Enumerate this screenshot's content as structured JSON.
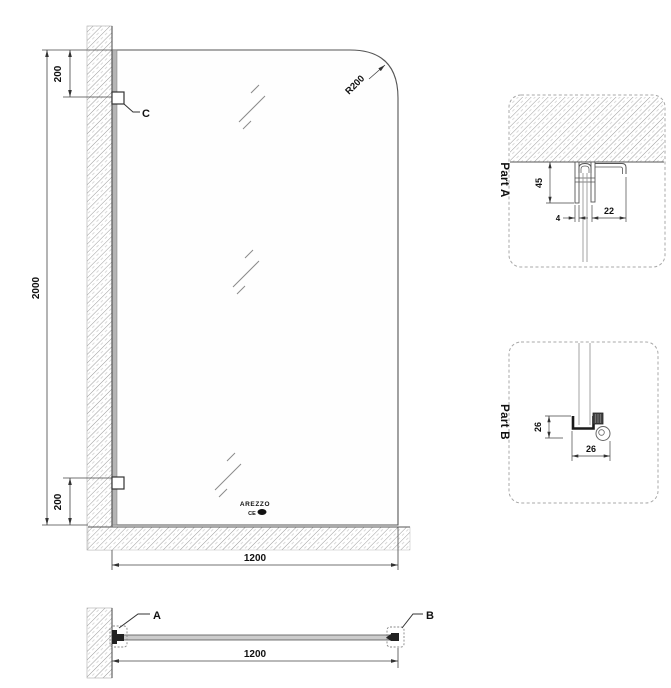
{
  "drawing": {
    "main_view": {
      "dim_total_height": "2000",
      "dim_top_offset": "200",
      "dim_bottom_offset": "200",
      "dim_width": "1200",
      "corner_radius_label": "R200",
      "bracket_label_c": "C",
      "logo_line1": "AREZZO",
      "logo_line2": "CE"
    },
    "plan_view": {
      "bracket_label_a": "A",
      "bracket_label_b": "B",
      "dim_width": "1200"
    },
    "part_a": {
      "title": "Part A",
      "dim_depth": "45",
      "dim_gap": "4",
      "dim_arm": "22"
    },
    "part_b": {
      "title": "Part B",
      "dim_height": "26",
      "dim_width": "26"
    },
    "colors": {
      "line": "#444444",
      "dark": "#1a1a1a",
      "hatch": "#9a9a9a",
      "glass_edge": "#b5b5b5"
    }
  }
}
